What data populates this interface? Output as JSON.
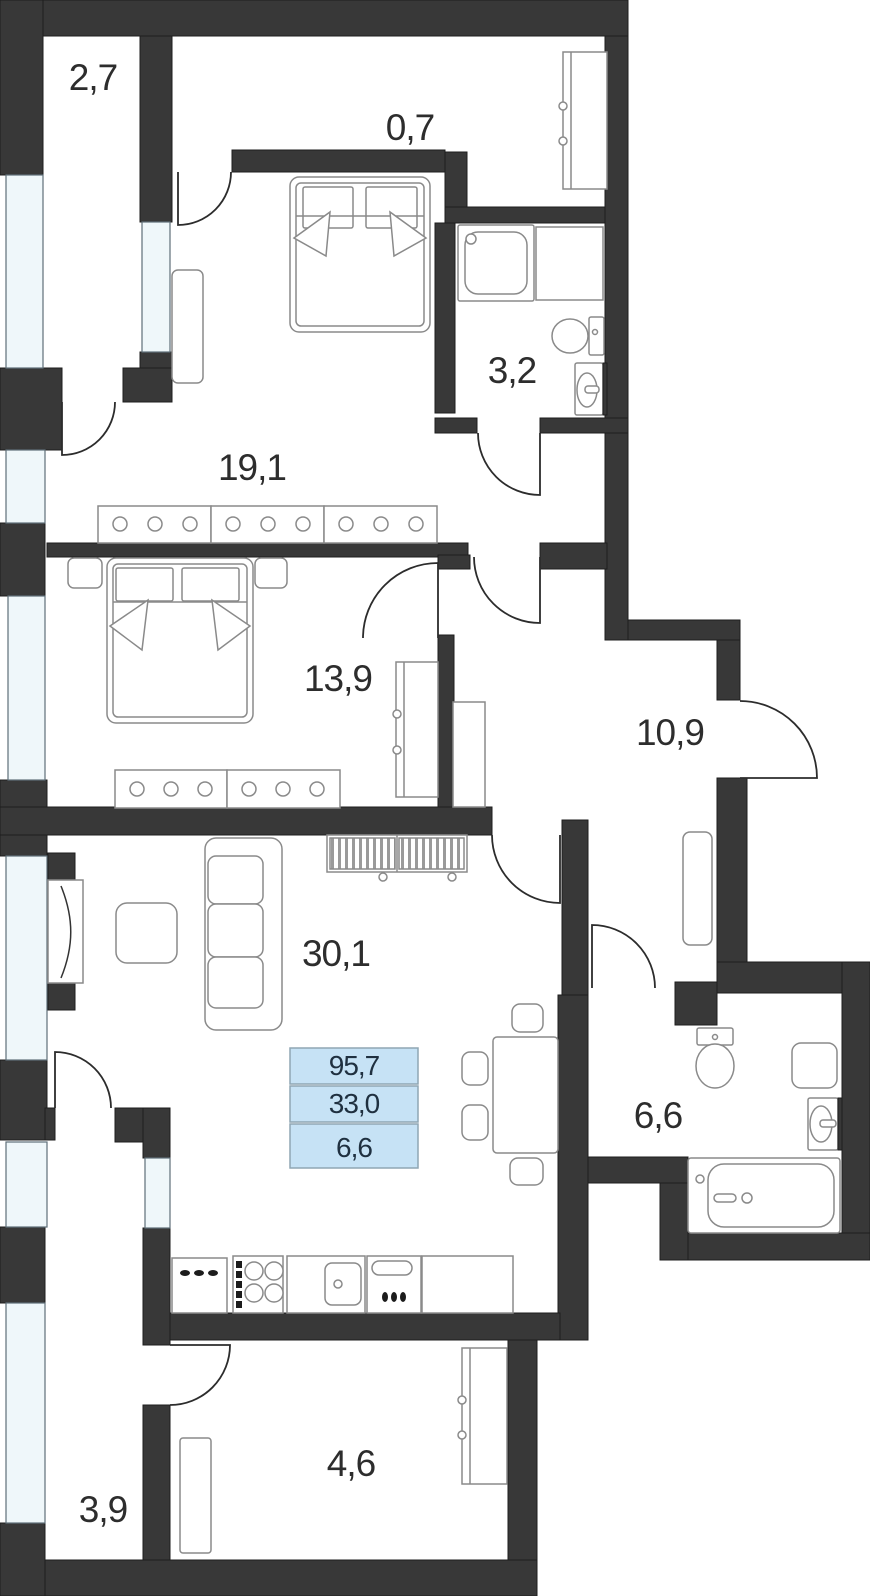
{
  "plan": {
    "type": "apartment-floor-plan",
    "rooms": [
      {
        "id": "balcony-top",
        "label": "2,7"
      },
      {
        "id": "walk-in-closet",
        "label": "0,7"
      },
      {
        "id": "bathroom-small",
        "label": "3,2"
      },
      {
        "id": "bedroom-1",
        "label": "19,1"
      },
      {
        "id": "bedroom-2",
        "label": "13,9"
      },
      {
        "id": "hallway",
        "label": "10,9"
      },
      {
        "id": "living-kitchen",
        "label": "30,1"
      },
      {
        "id": "bathroom-main",
        "label": "6,6"
      },
      {
        "id": "balcony-bottom",
        "label": "3,9"
      },
      {
        "id": "entry-room",
        "label": "4,6"
      }
    ],
    "info_box": {
      "total_area": "95,7",
      "living_area": "33,0",
      "kitchen_area": "6,6"
    },
    "colors": {
      "wall": "#383838",
      "window": "#eff7fa",
      "info_fill": "#c6e2f5",
      "info_border": "#8fa6b4",
      "text": "#2d2d2d"
    }
  }
}
